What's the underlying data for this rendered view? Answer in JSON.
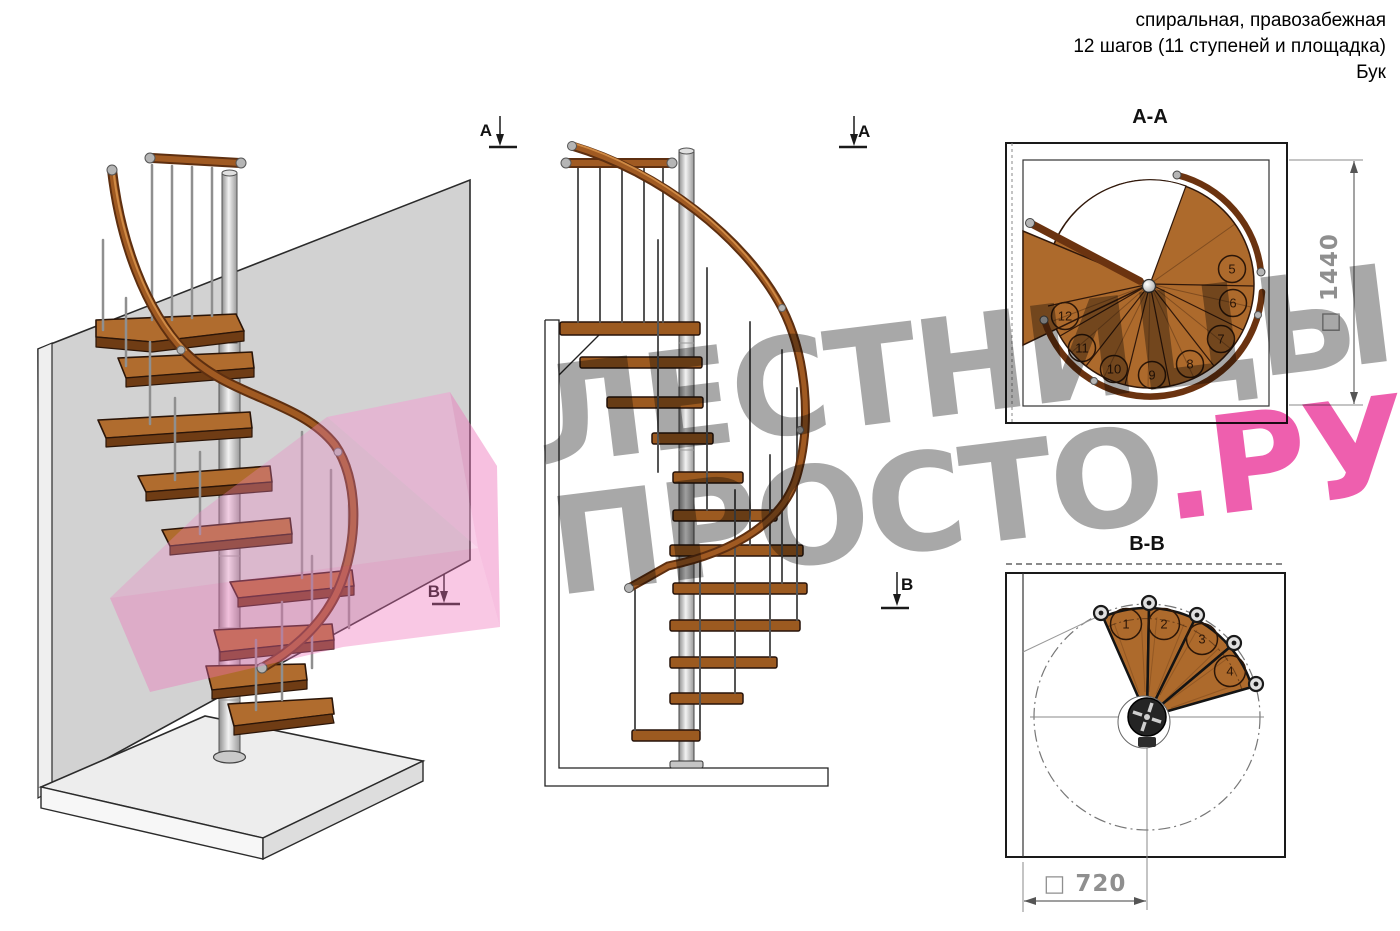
{
  "header": {
    "line1": "спиральная, правозабежная",
    "line2": "12 шагов (11 ступеней и площадка)",
    "line3": "Бук"
  },
  "watermark": {
    "line1": "ЛЕСТНИЦЫ",
    "line2_gray": "ПРОСТО",
    "line2_pink": ".РУ",
    "gray_color": "#a8a8a8",
    "pink_color": "#ee5fae"
  },
  "section_markers": {
    "a_left": "А",
    "a_right": "А",
    "b_left": "В",
    "b_right": "В"
  },
  "plan_aa": {
    "title": "А-А",
    "dimension": "□ 1440",
    "steps": [
      "5",
      "6",
      "7",
      "8",
      "9",
      "10",
      "11",
      "12"
    ]
  },
  "plan_bb": {
    "title": "В-В",
    "dimension": "□ 720",
    "steps": [
      "1",
      "2",
      "3",
      "4"
    ]
  },
  "colors": {
    "wood": "#b06c2e",
    "wood_dark": "#6f3c14",
    "handrail": "#6b3310",
    "steel": "#c8c8c8",
    "wall": "#d2d2d2",
    "pink_overlay": "#ee74ba",
    "dimension_text": "#8f8f8f"
  }
}
